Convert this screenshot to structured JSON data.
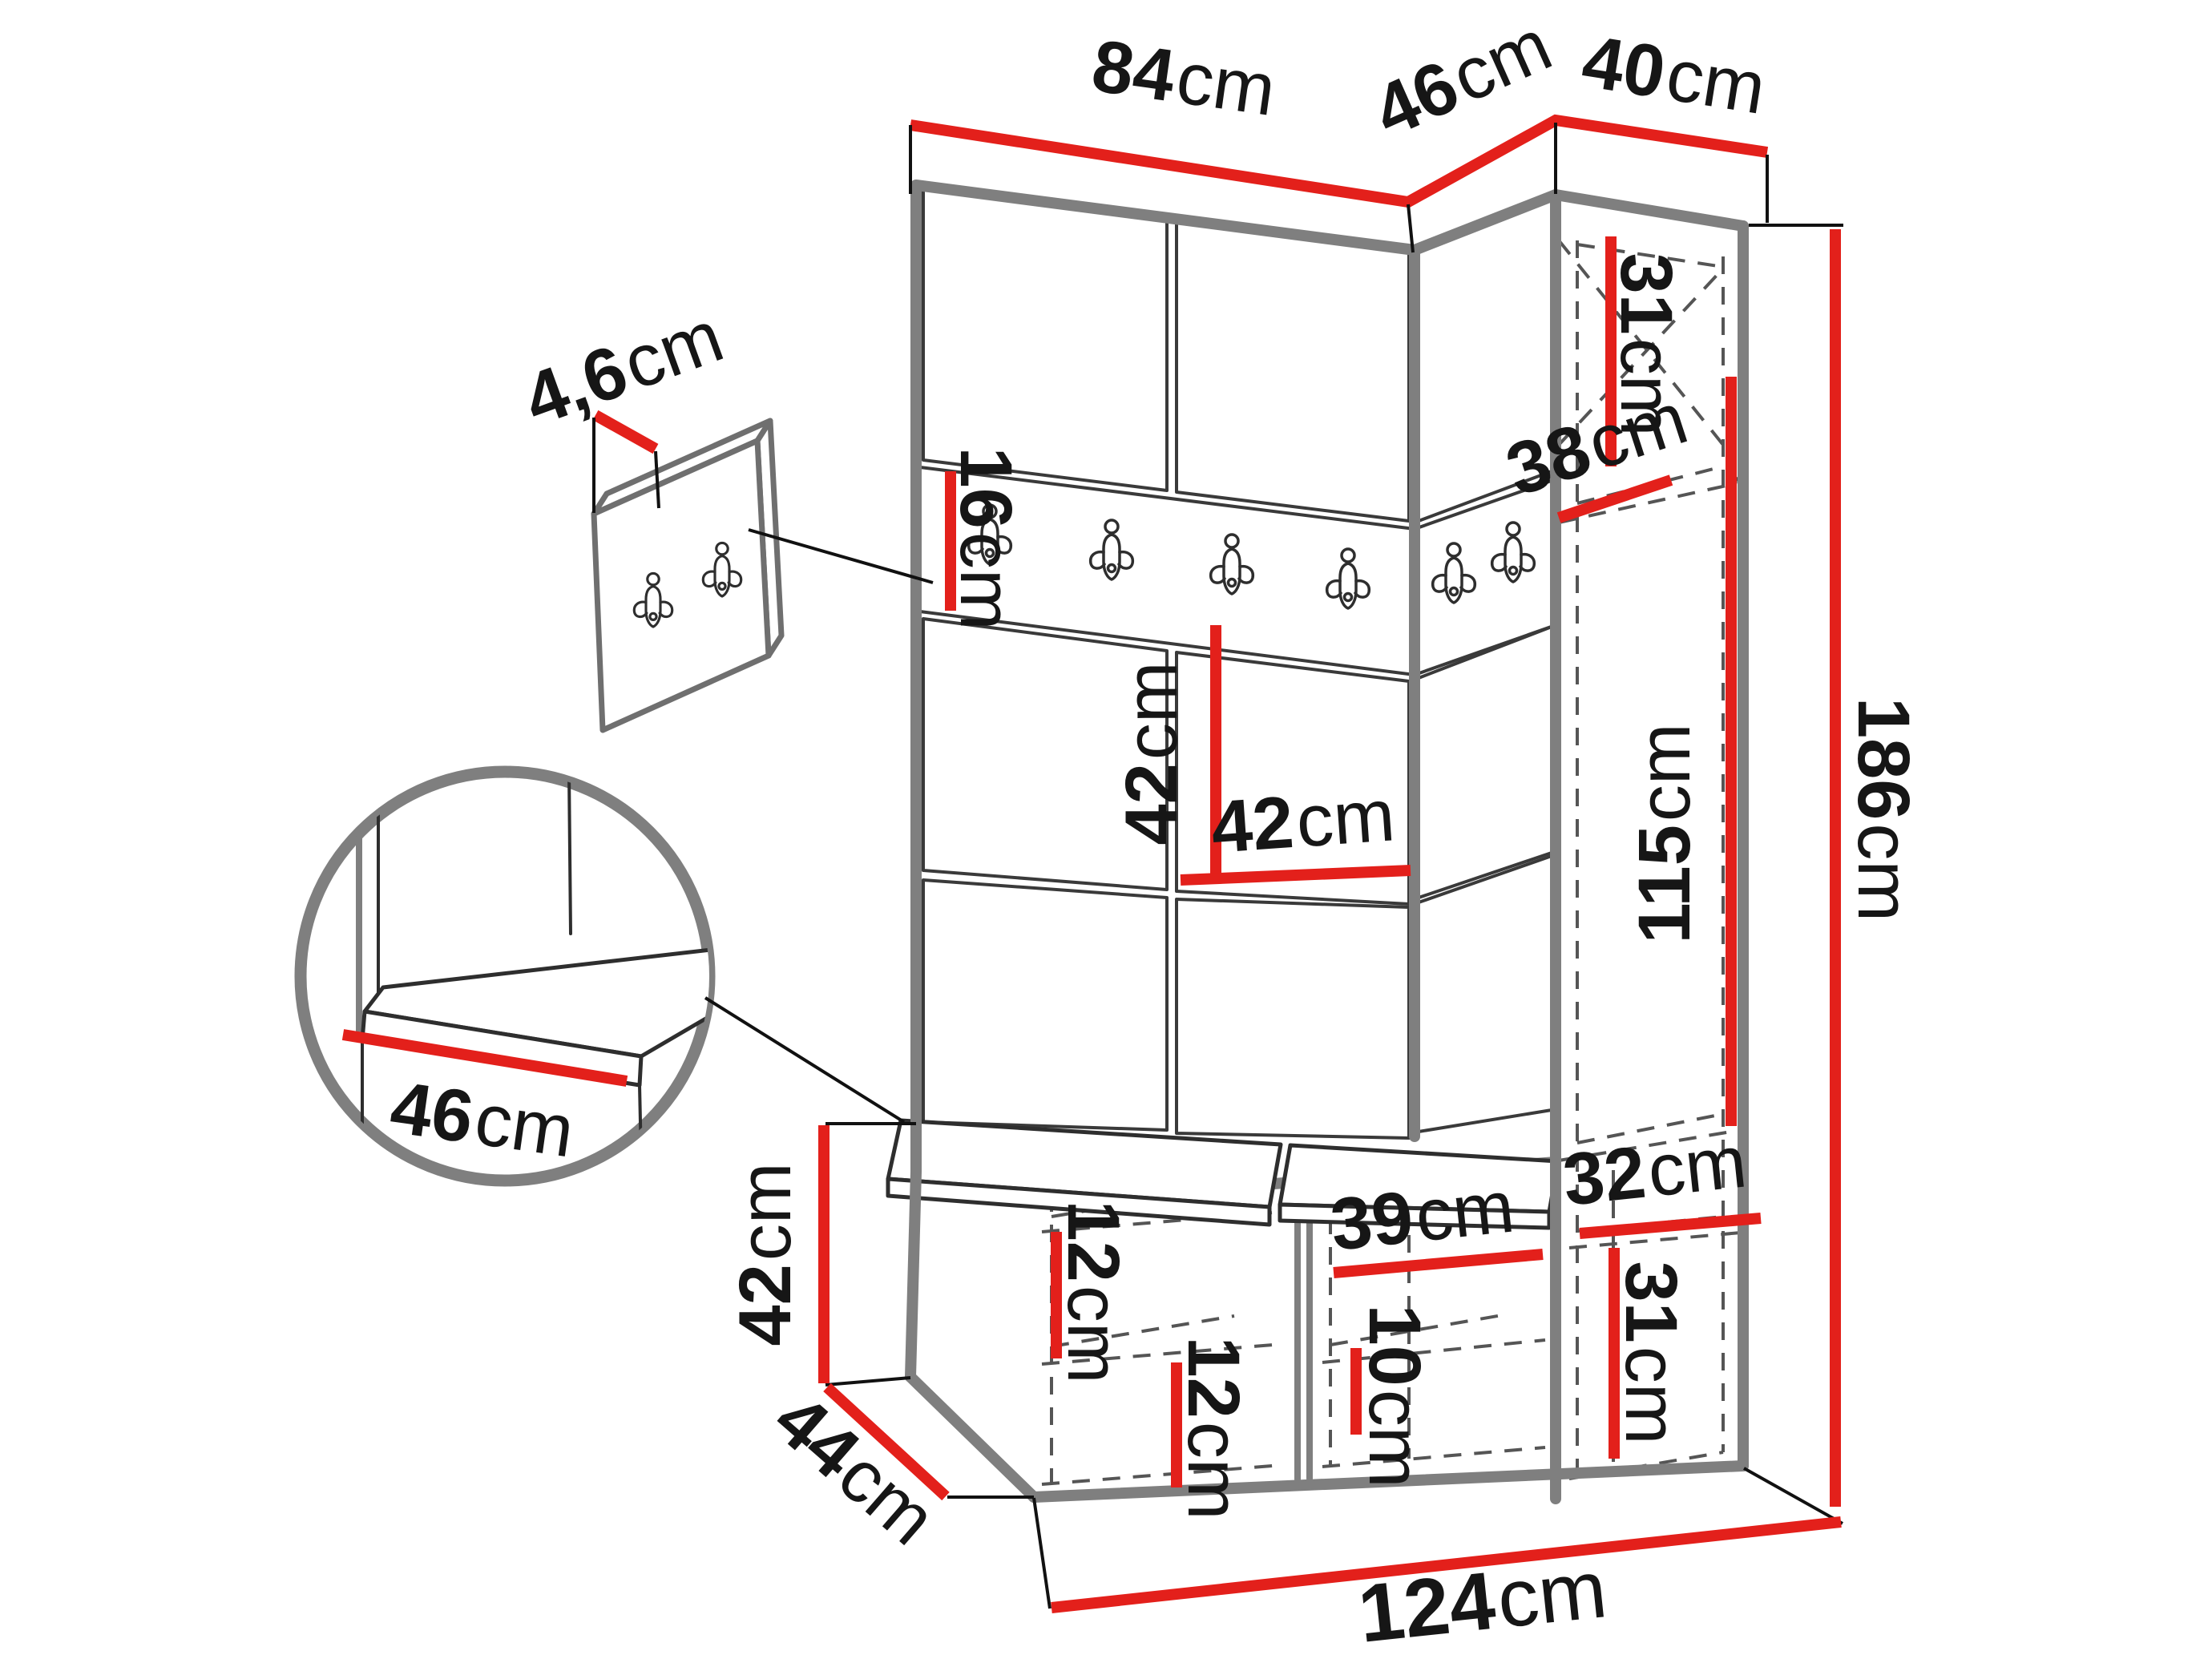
{
  "diagram": {
    "type": "furniture dimension drawing",
    "subject": "hallway wardrobe set: upholstered panel wall with hook rail, tall cabinet, shoe bench with cushions, wall hook panel"
  },
  "colors": {
    "dimension_line": "#e3201b",
    "outline_gray": "#7f7f7f",
    "detail_line": "#2e2e2e",
    "label_text": "#161616"
  },
  "dimensions": {
    "top_width_left": {
      "value": "84",
      "unit": "cm"
    },
    "top_width_middle": {
      "value": "46",
      "unit": "cm"
    },
    "top_width_right": {
      "value": "40",
      "unit": "cm"
    },
    "hook_panel_thickness": {
      "value": "4,6",
      "unit": "cm"
    },
    "hook_rail_height": {
      "value": "16",
      "unit": "cm"
    },
    "wall_panel_height": {
      "value": "42",
      "unit": "cm"
    },
    "wall_panel_width": {
      "value": "42",
      "unit": "cm"
    },
    "cabinet_top_section_height": {
      "value": "31",
      "unit": "cm"
    },
    "cabinet_shelf_depth": {
      "value": "38",
      "unit": "cm"
    },
    "cabinet_hanging_height": {
      "value": "115",
      "unit": "cm"
    },
    "total_height": {
      "value": "186",
      "unit": "cm"
    },
    "bench_height": {
      "value": "42",
      "unit": "cm"
    },
    "bench_depth": {
      "value": "44",
      "unit": "cm"
    },
    "bench_shelf_gap_left": {
      "value": "12",
      "unit": "cm"
    },
    "bench_shelf_gap_middle": {
      "value": "12",
      "unit": "cm"
    },
    "bench_compartment_width": {
      "value": "39",
      "unit": "cm"
    },
    "bench_shelf_gap_right": {
      "value": "10",
      "unit": "cm"
    },
    "cabinet_inner_width": {
      "value": "32",
      "unit": "cm"
    },
    "cabinet_bottom_section_height": {
      "value": "31",
      "unit": "cm"
    },
    "total_width": {
      "value": "124",
      "unit": "cm"
    },
    "seat_cushion_depth": {
      "value": "46",
      "unit": "cm"
    }
  }
}
